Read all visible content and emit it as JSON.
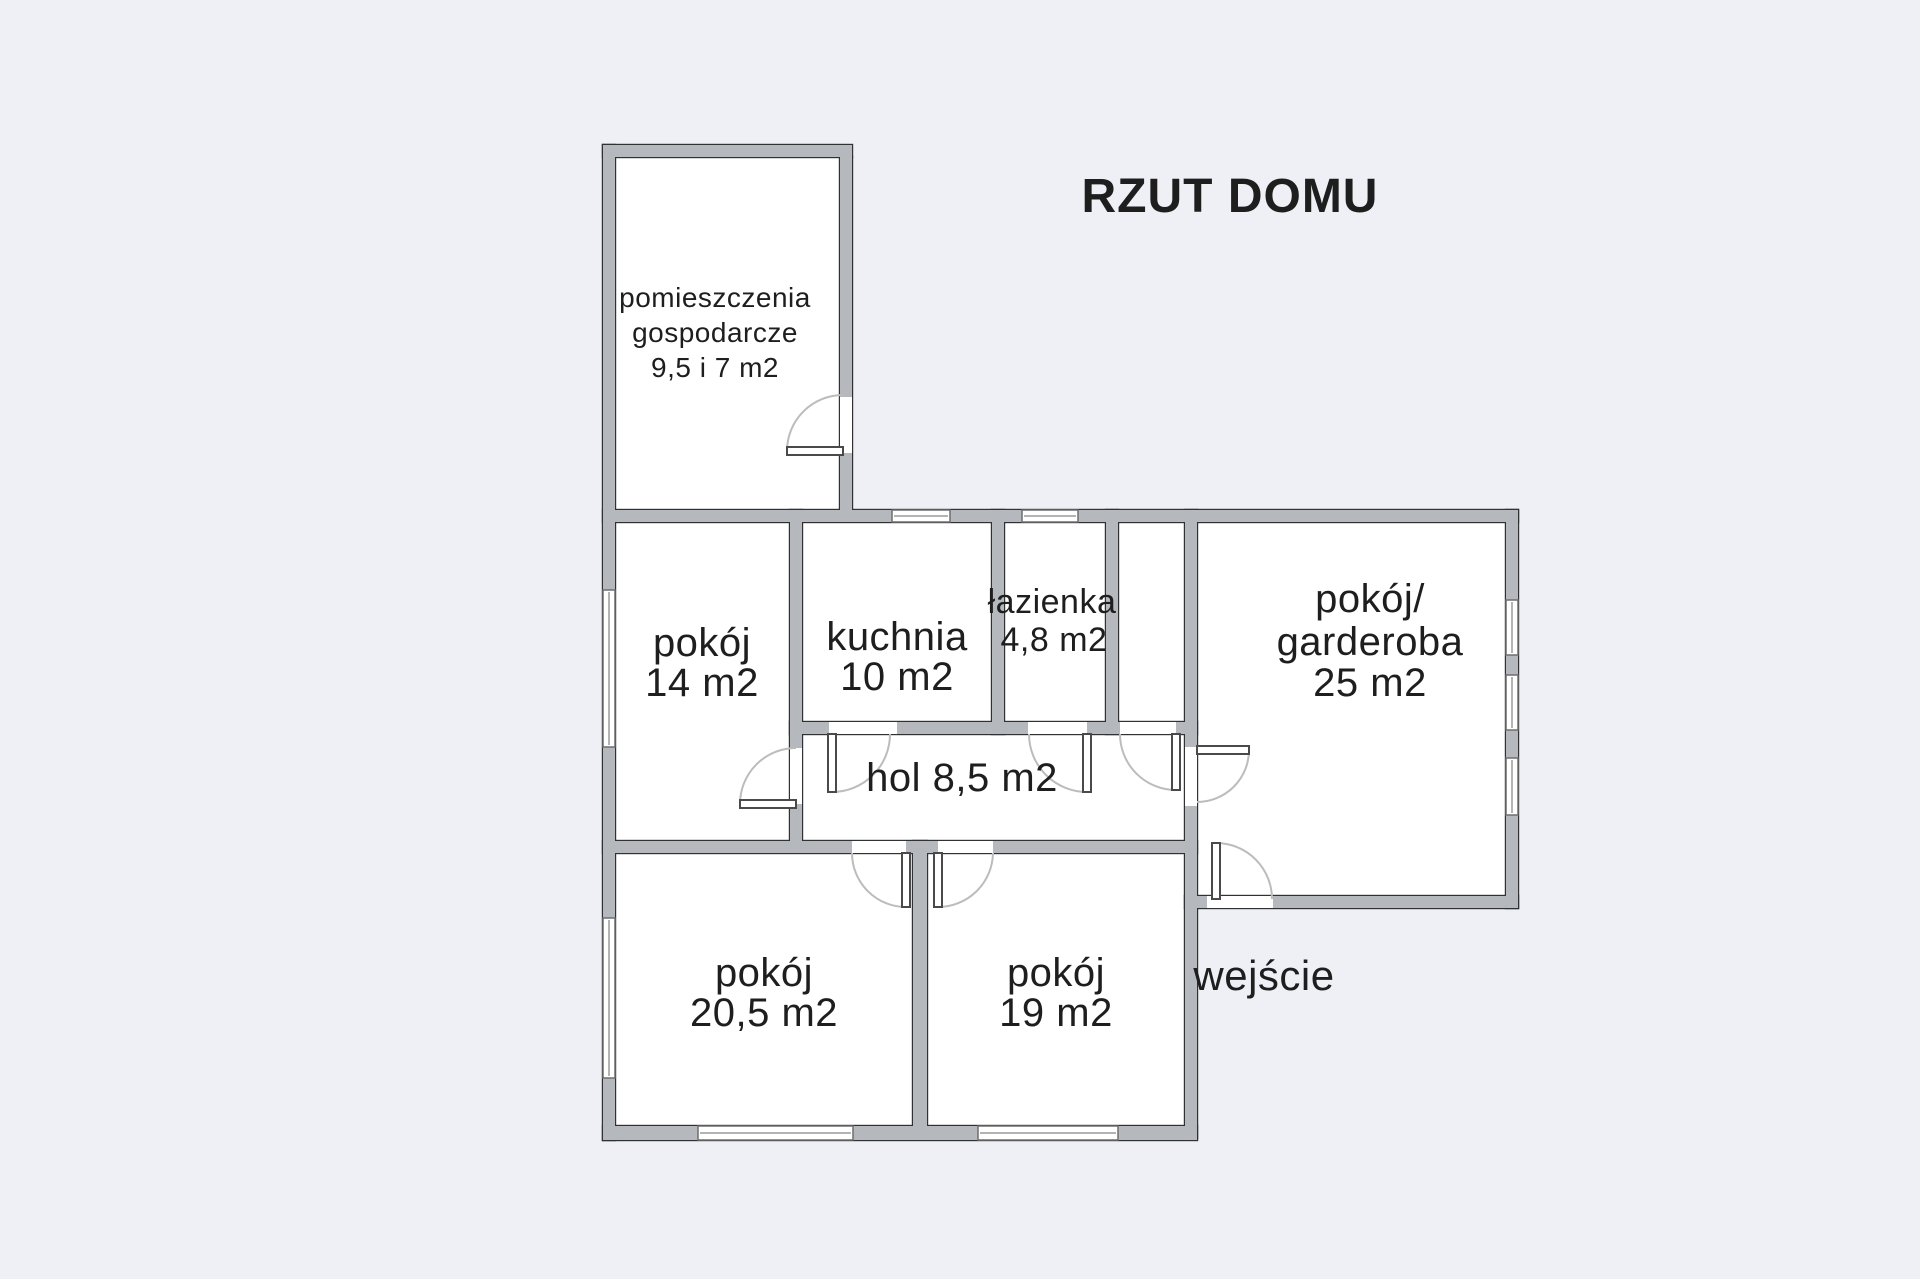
{
  "title": "RZUT DOMU",
  "colors": {
    "background": "#eef0f5",
    "wall_fill": "#b5b8bc",
    "wall_outline": "#2f3133",
    "room_fill": "#ffffff",
    "text": "#1e1e1e",
    "door_arc": "#bcbcbc"
  },
  "rooms": {
    "gospodarcze": {
      "name": "pomieszczenia gospodarcze",
      "area": "9,5 i 7 m2",
      "lines": [
        "pomieszczenia",
        "gospodarcze",
        "9,5 i 7 m2"
      ]
    },
    "pokoj_14": {
      "name": "pokój",
      "area": "14 m2",
      "lines": [
        "pokój",
        "14 m2"
      ]
    },
    "kuchnia": {
      "name": "kuchnia",
      "area": "10 m2",
      "lines": [
        "kuchnia",
        "10 m2"
      ]
    },
    "lazienka": {
      "name": "łazienka",
      "area": "4,8 m2",
      "lines": [
        "łazienka",
        "4,8 m2"
      ]
    },
    "garderoba": {
      "name": "pokój/garderoba",
      "area": "25 m2",
      "lines": [
        "pokój/",
        "garderoba",
        "25 m2"
      ]
    },
    "hol": {
      "name": "hol",
      "area": "8,5 m2",
      "lines": [
        "hol 8,5 m2"
      ]
    },
    "pokoj_205": {
      "name": "pokój",
      "area": "20,5 m2",
      "lines": [
        "pokój",
        "20,5 m2"
      ]
    },
    "pokoj_19": {
      "name": "pokój",
      "area": "19 m2",
      "lines": [
        "pokój",
        "19 m2"
      ]
    },
    "wejscie": {
      "name": "wejście",
      "area": "",
      "lines": [
        "wejście"
      ]
    }
  }
}
